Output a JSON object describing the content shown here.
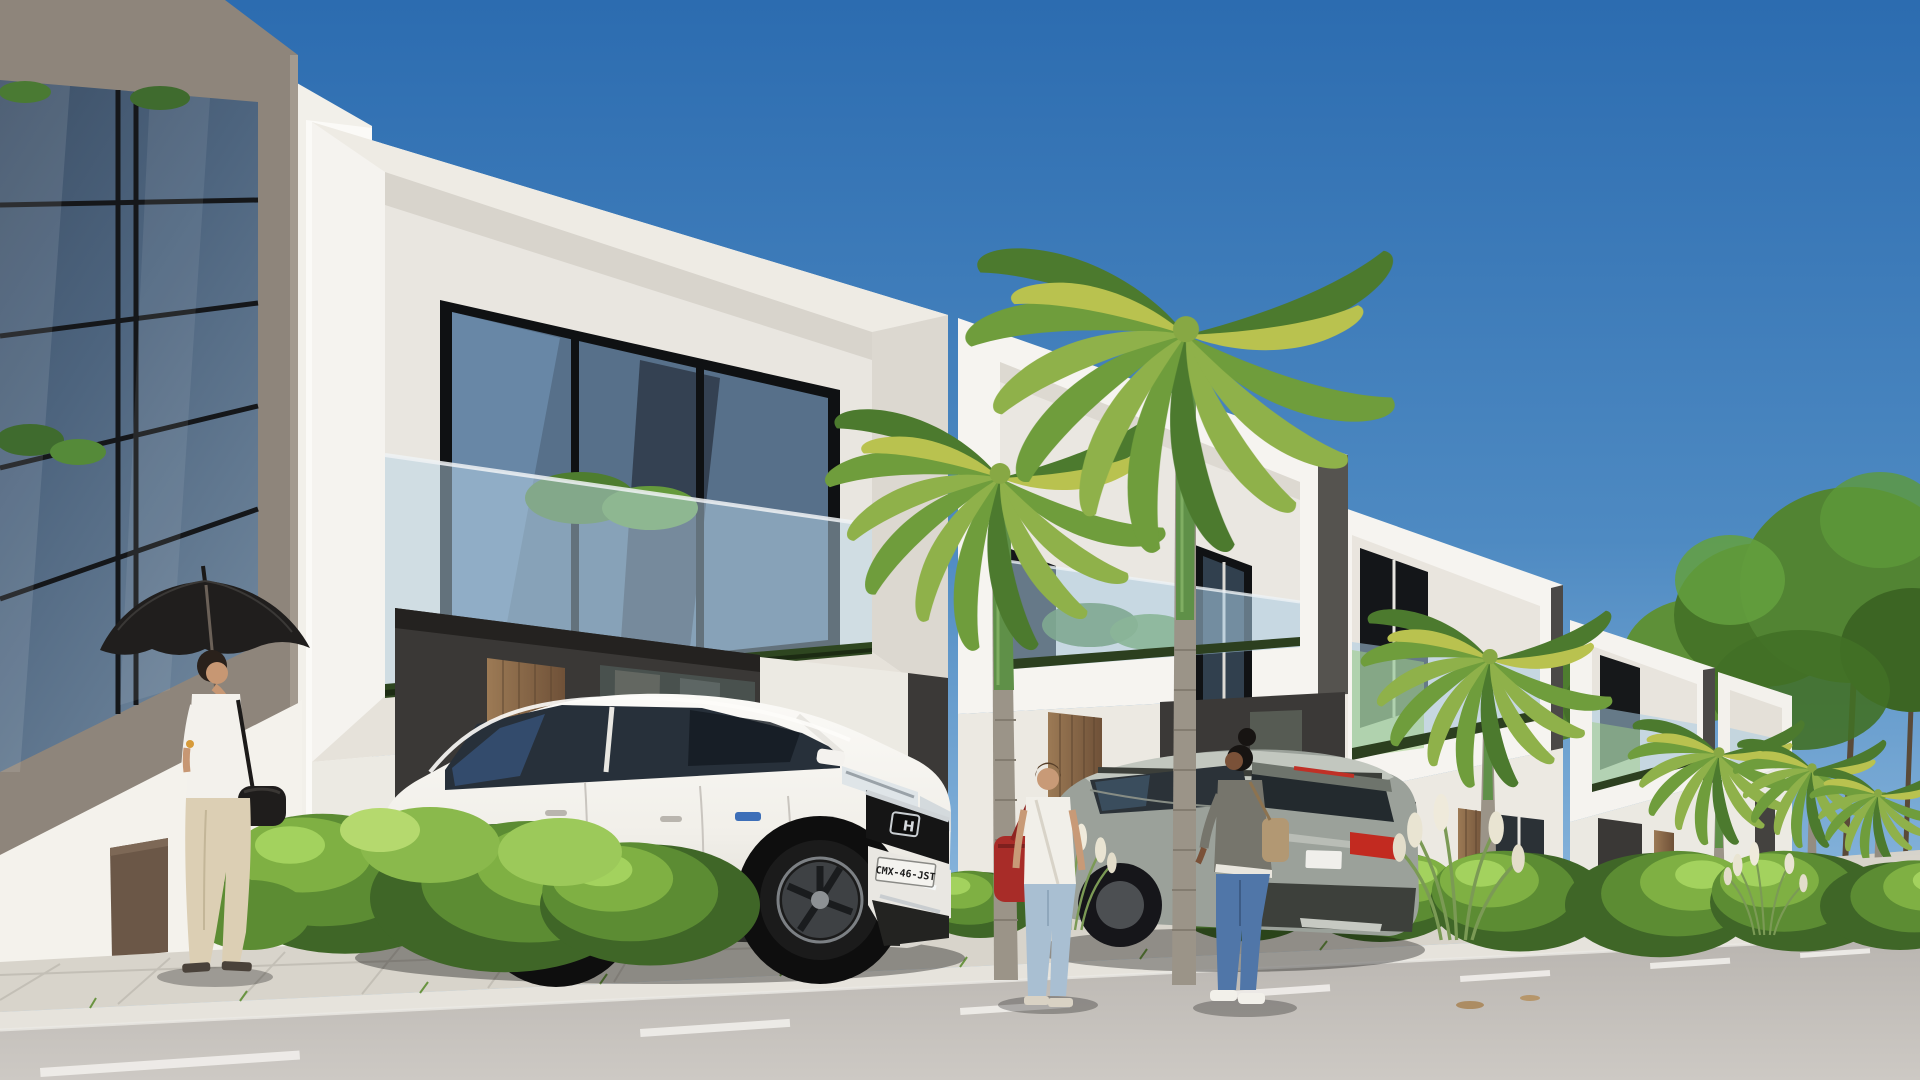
{
  "scene": {
    "objects": [
      "sky",
      "glass-facade-office-building",
      "row-of-modern-white-villas",
      "cantilever-balconies",
      "royal-palm-trees",
      "background-trees",
      "concrete-boundary-wall",
      "hedges",
      "ornamental-grass",
      "white-suv",
      "gray-suv",
      "woman-with-umbrella",
      "man-with-red-bag",
      "woman-with-tan-bag",
      "sidewalk",
      "curb",
      "asphalt-road",
      "dashed-lane-marking"
    ]
  },
  "vehicles": {
    "white_suv": {
      "name": "white-suv",
      "license_plate": "CMX-46-JST",
      "emblem_letter": "H",
      "hybrid_badge_color": "#3d6fb8"
    },
    "gray_suv": {
      "name": "gray-suv",
      "license_plate": ""
    }
  },
  "people": [
    {
      "name": "woman-with-umbrella"
    },
    {
      "name": "man-with-red-bag"
    },
    {
      "name": "woman-with-tan-bag"
    }
  ],
  "colors": {
    "sky_top": "#2c6cb0",
    "sky_mid": "#4e8ac2",
    "sky_horizon": "#97c0e2",
    "villa_white": "#f5f3ef",
    "soffit_shade": "#e0dcd4",
    "accent_charcoal": "#3a3836",
    "frame_taupe": "#8e857b",
    "glass_dark": "#43566c",
    "balcony_glass": "#a9cce3",
    "balcony_glass_green": "#9fce85",
    "door_wood": "#8a6748",
    "hedge_light": "#8ab94c",
    "hedge_mid": "#5c8c33",
    "hedge_dark": "#3f6627",
    "palm_frond": "#6f9d3c",
    "palm_frond_accent": "#b9c24f",
    "trunk_gray": "#9b9488",
    "trunk_green": "#5f9048",
    "wall_concrete": "#bab6ae",
    "sidewalk": "#d8d4cb",
    "curb": "#e6e3dc",
    "road": "#b9b5b0",
    "road_near": "#cdc9c4",
    "lane_marking": "#f1efeb",
    "white_suv_body": "#f4f2ee",
    "gray_suv_body": "#9ba19a",
    "taillight_red": "#c22a20",
    "umbrella_black": "#201e1d",
    "bag_red": "#a82c28",
    "jeans_light": "#a9bfd2",
    "jeans_dark": "#5076a8",
    "jacket_olive": "#76756c",
    "pants_beige": "#dccfb4",
    "skin_light": "#c79773",
    "skin_dark": "#7a5138"
  }
}
